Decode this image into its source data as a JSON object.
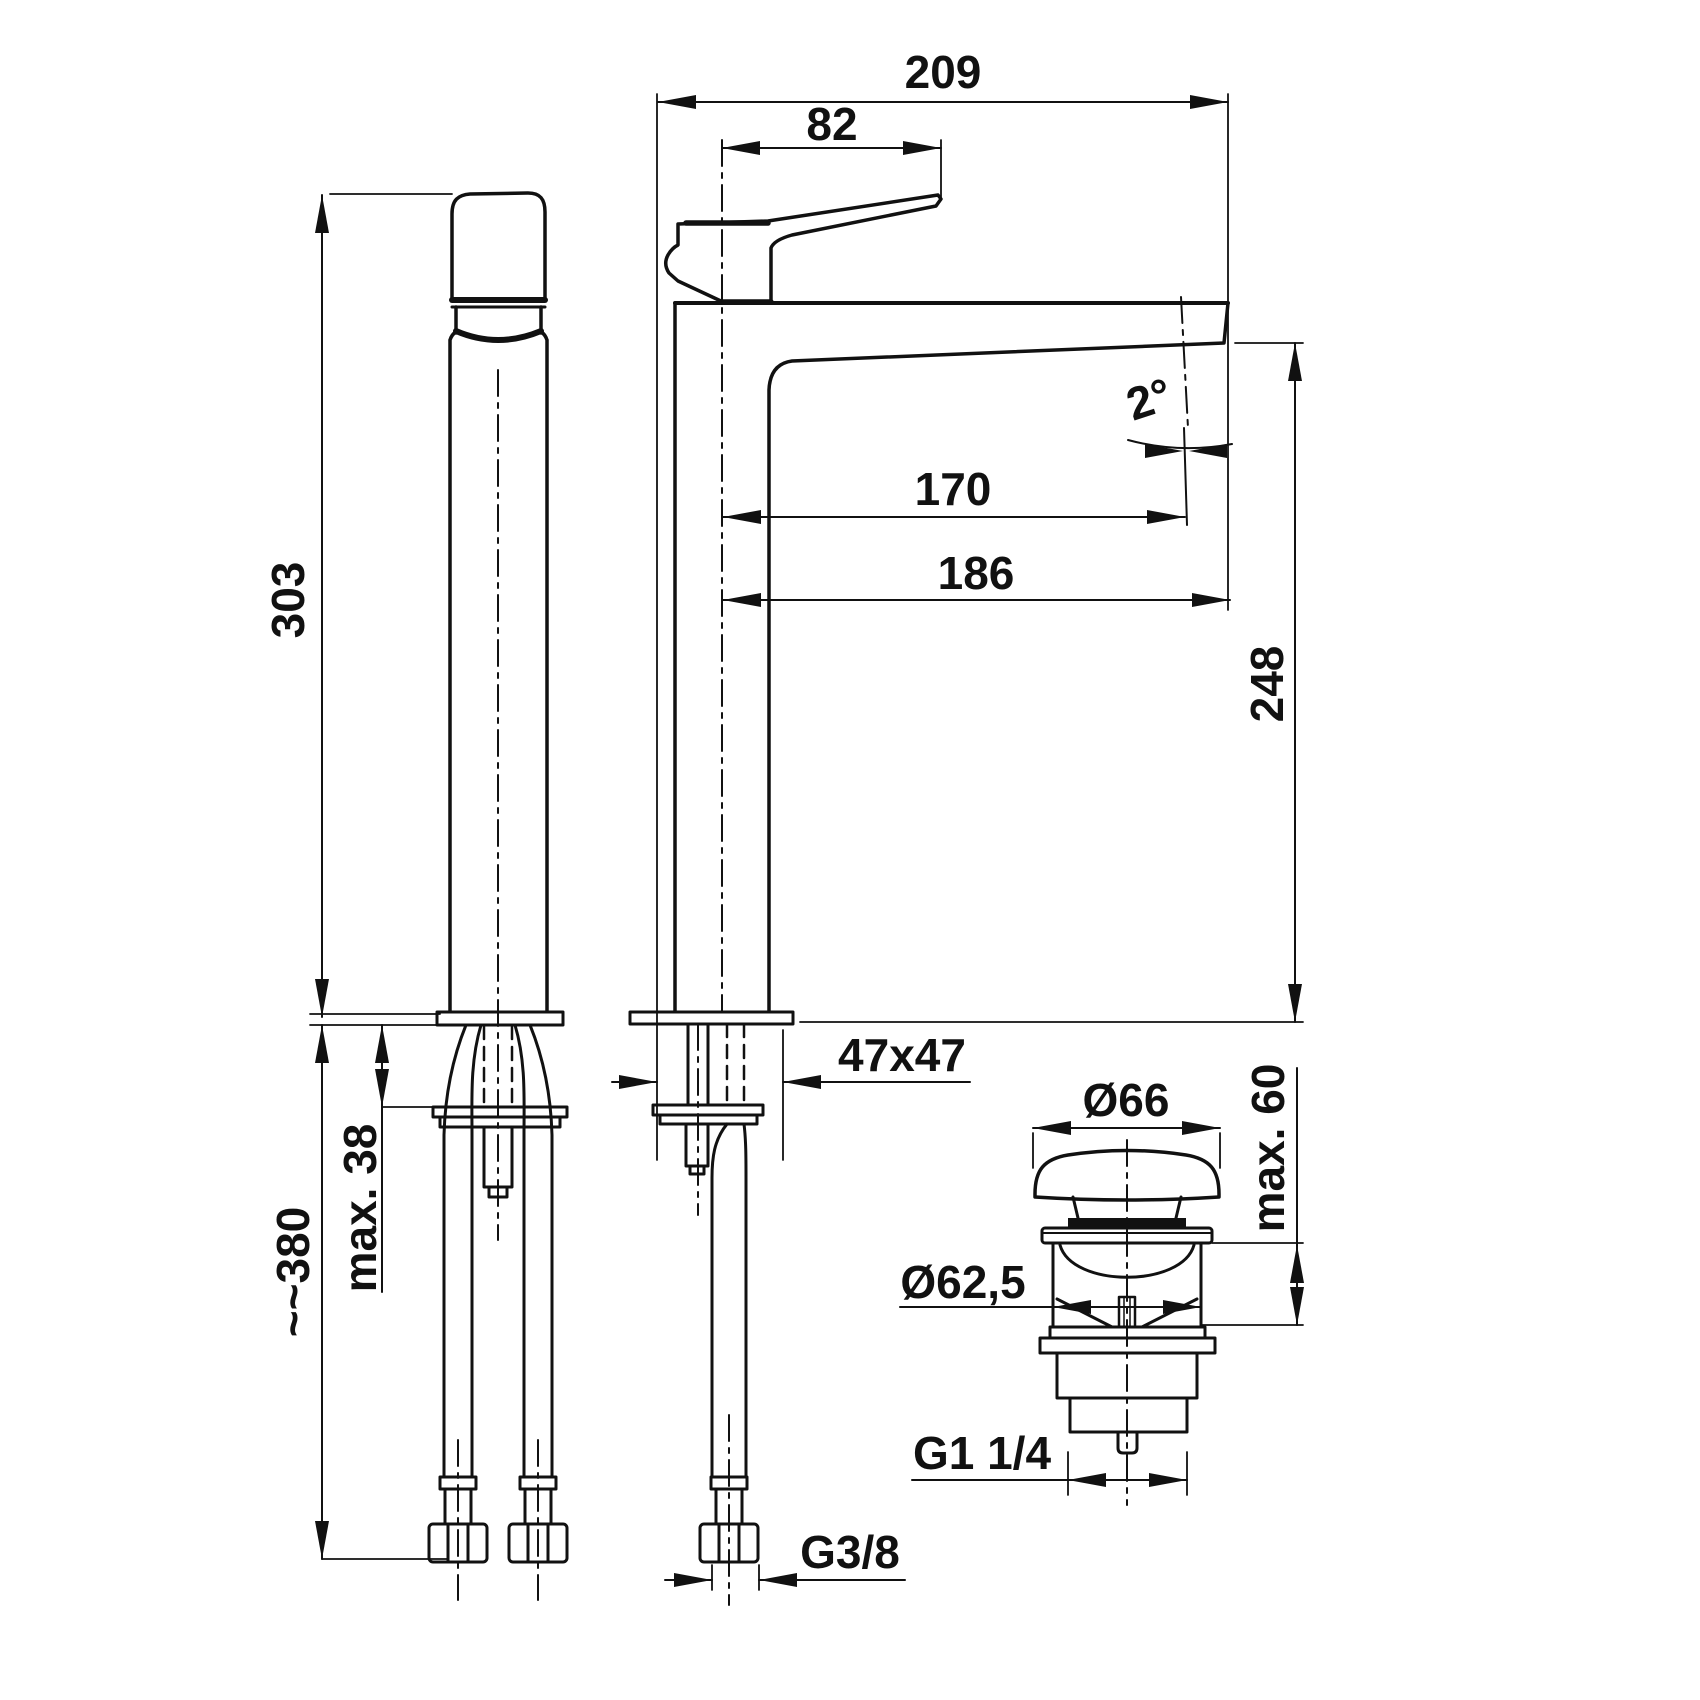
{
  "drawing": {
    "type": "technical-dimension-drawing",
    "subject": "tall single-lever basin mixer with flexible hoses and push-open waste",
    "background": "#ffffff",
    "line_color": "#111111",
    "labels": {
      "total_depth": "209",
      "handle_length": "82",
      "spout_angle": "2°",
      "spout_reach": "170",
      "spout_reach_outer": "186",
      "spout_height": "248",
      "body_height": "303",
      "deck_thickness_max": "max. 38",
      "hose_length": "~~380",
      "base_cross_section": "47x47",
      "hose_thread": "G3/8",
      "waste_cap_diameter": "Ø66",
      "waste_deck_max": "max. 60",
      "waste_body_diameter": "Ø62,5",
      "waste_thread": "G1 1/4"
    }
  }
}
